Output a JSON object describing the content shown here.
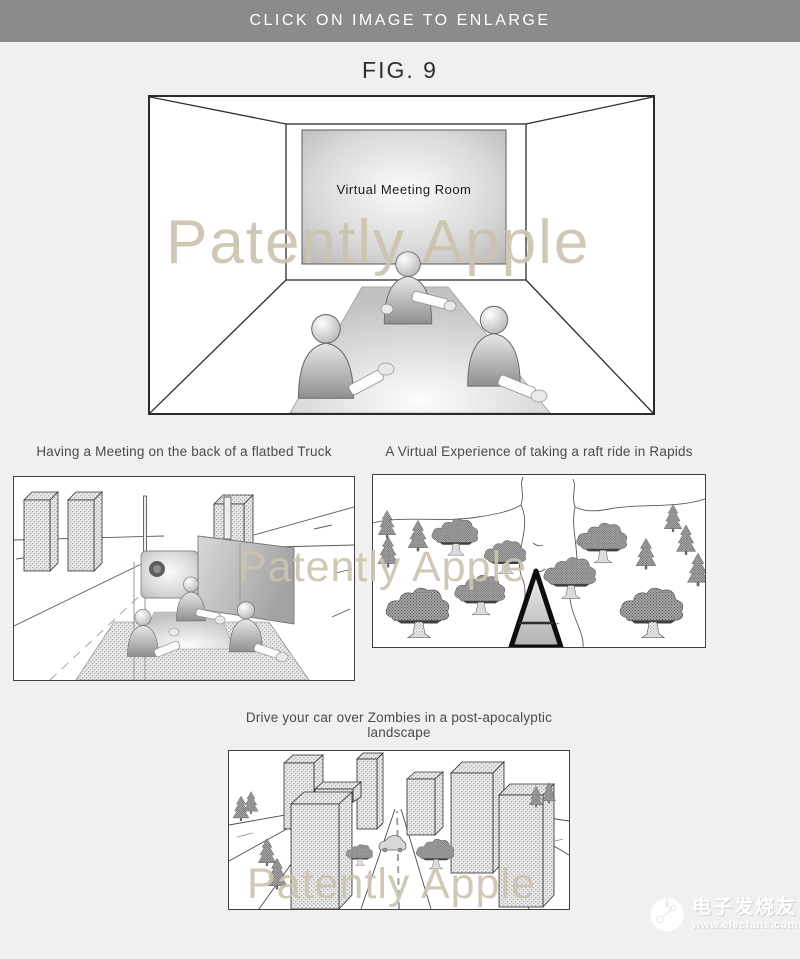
{
  "page": {
    "background": "#f0f0ee"
  },
  "banner": {
    "label": "CLICK ON IMAGE TO ENLARGE",
    "bg": "#8b8b8b",
    "text_color": "#ffffff"
  },
  "figure": {
    "label": "FIG. 9"
  },
  "watermark": {
    "text": "Patently Apple",
    "color": "#ccc4b0"
  },
  "main_panel": {
    "screen_label": "Virtual Meeting Room"
  },
  "panels": {
    "truck": {
      "caption": "Having a Meeting on the back of a flatbed Truck"
    },
    "rapids": {
      "caption": "A Virtual Experience of taking a raft ride in Rapids"
    },
    "zombies": {
      "caption": "Drive your car over Zombies in a post-apocalyptic landscape"
    }
  },
  "site_badge": {
    "site_name": "电子发烧友",
    "site_url": "www.elecfans.com"
  }
}
